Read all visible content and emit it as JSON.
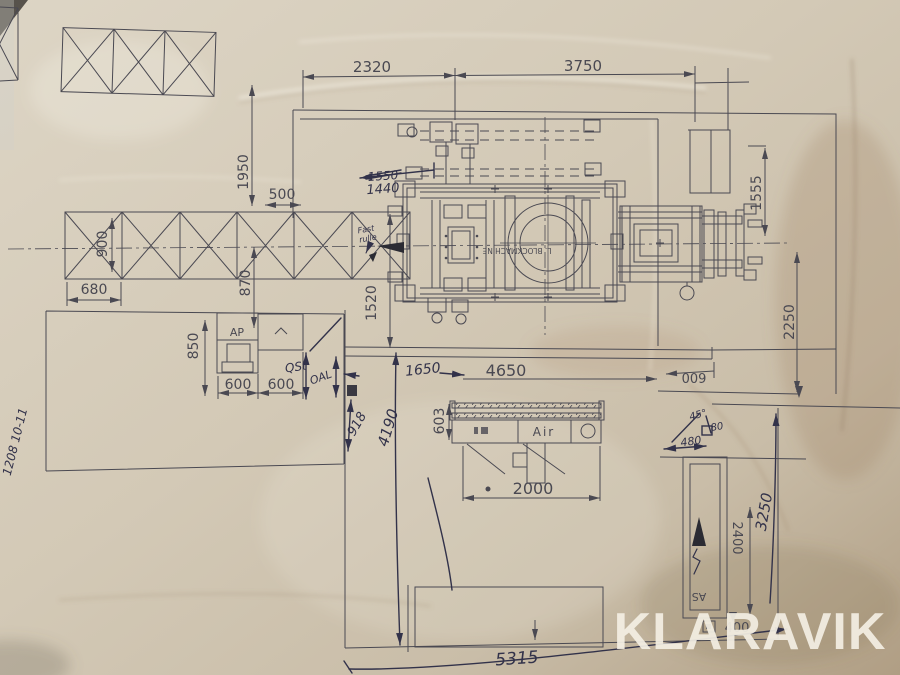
{
  "photo": {
    "watermark": "KLARAVIK"
  },
  "printed": {
    "dim_2320": "2320",
    "dim_3750": "3750",
    "dim_1950": "1950",
    "dim_500": "500",
    "dim_900": "900",
    "dim_680": "680",
    "dim_870": "870",
    "dim_1520": "1520",
    "dim_1555": "1555",
    "dim_2250": "2250",
    "dim_850": "850",
    "dim_600_left": "600",
    "dim_600_right": "600",
    "dim_4650": "4650",
    "dim_600_rotated": "600",
    "dim_603": "603",
    "dim_2000": "2000",
    "dim_2400": "2400",
    "dim_400": "400",
    "label_ap": "AP",
    "label_air": "Air",
    "label_as": "AS",
    "label_machine": "L. BLOCKMACHINE"
  },
  "handwritten": {
    "crossed_value": "1550",
    "corrected_value": "1440",
    "note_fast": "Fast",
    "note_rulle": "rulle",
    "note_qst": "QSt",
    "note_oal": "OAL",
    "dim_918": "918",
    "dim_4190": "4190",
    "dim_1650": "1650",
    "angle_45": "45°",
    "dim_80": "80",
    "dim_480": "480",
    "dim_3250": "3250",
    "dim_5315": "5315",
    "doc_ref": "1208 10-11"
  },
  "colors": {
    "paper": "#d3c9b6",
    "ink_printed": "#4a4952",
    "ink_hand": "#32324a",
    "watermark": "#f4efe4"
  }
}
